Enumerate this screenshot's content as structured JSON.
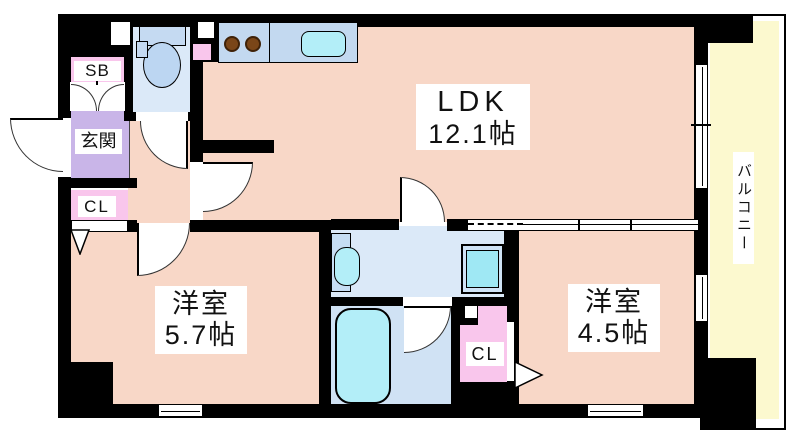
{
  "plan": {
    "ldk": {
      "label": "LDK",
      "area": "12.1帖"
    },
    "western_room_1": {
      "label": "洋室",
      "area": "5.7帖"
    },
    "western_room_2": {
      "label": "洋室",
      "area": "4.5帖"
    },
    "entrance_label": "玄関",
    "shoe_box_label": "SB",
    "closet_entrance_label": "CL",
    "closet_bedroom_label": "CL",
    "balcony_label": "バルコニー"
  },
  "colors": {
    "wall": "#000000",
    "room_floor": "#f8d7c7",
    "entrance_floor": "#c9b5e8",
    "closet_pink": "#f9c6ec",
    "wet_area_floor": "#dbe9f8",
    "bath_floor": "#d0e2f4",
    "fixture_blue": "#c3d9f0",
    "water_cyan": "#b3eef8",
    "washer_cyan": "#9fe8f4",
    "balcony_yellow": "#fcf9cf",
    "burner_brown": "#7a4618",
    "label_text": "#111111"
  }
}
